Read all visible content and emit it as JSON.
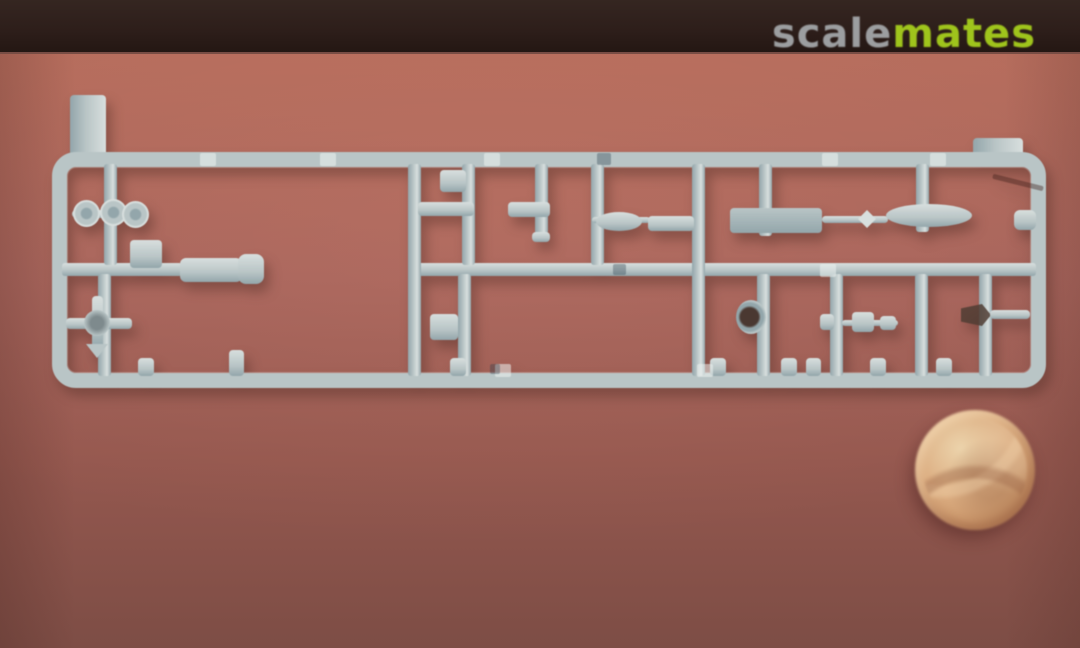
{
  "watermark": {
    "scale": "scale",
    "mates": "mates"
  },
  "colors": {
    "band": "#2d1e1a",
    "band-edge": "#c97f72",
    "surface-top": "#b56c5c",
    "surface-mid": "#a5635b",
    "surface-low": "#95584f",
    "surface-bottom": "#7d4d45",
    "plastic": "#b9c5c6",
    "plastic-light": "#d8dfde",
    "plastic-dark": "#93a6ab",
    "wm-scale": "#9c9ea0",
    "wm-mates": "#9fc41c",
    "coin-hi": "#ecd3ab",
    "coin-mid": "#dcae82",
    "coin-low": "#b58257"
  },
  "scene": {
    "objects": [
      {
        "name": "injection-molded-sprue",
        "color": "#b9c5c6"
      },
      {
        "name": "coin-for-scale",
        "color": "#dcae82"
      }
    ]
  }
}
